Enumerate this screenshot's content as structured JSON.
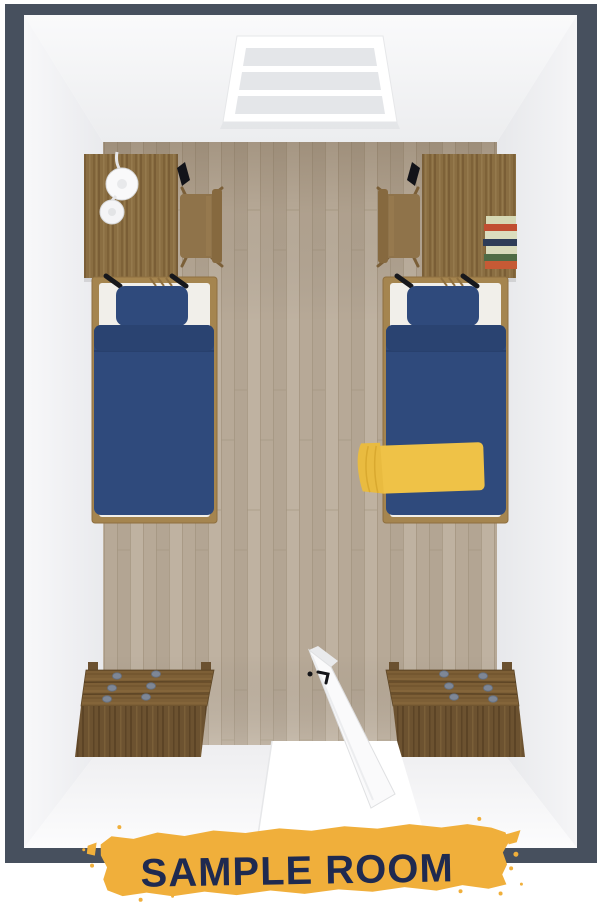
{
  "banner": {
    "label": "SAMPLE ROOM"
  },
  "room": {
    "description": "top-down 3D render of a sample dorm room",
    "objects": [
      "window",
      "desk-left",
      "desk-lamp",
      "desk-item-left",
      "chair-left",
      "desk-right",
      "chair-right",
      "book-stack",
      "desk-item-right",
      "bed-left",
      "pillow-left",
      "duvet-left",
      "bed-right",
      "pillow-right",
      "duvet-right",
      "yellow-blanket",
      "dresser-left",
      "dresser-right",
      "open-door",
      "doorway"
    ]
  },
  "colors": {
    "wall_top": "#47505E",
    "interior_wall": "#F1F2F4",
    "floor_base": "#B8AB99",
    "desk_wood": "#8A6E42",
    "chair_wood": "#8F734A",
    "bed_frame": "#A5854F",
    "mattress": "#F1EFEA",
    "bedding_blue": "#2F4A7C",
    "bedding_blue_dark": "#2A4371",
    "blanket_yellow": "#EFC247",
    "blanket_yellow_dark": "#E9BB40",
    "dresser_top": "#7D5F36",
    "dresser_front": "#6C5230",
    "knob_gray": "#7E8796",
    "door_white": "#FAFAFB",
    "window_pane": "#E4E6E9",
    "banner_yellow": "#F0AF3B",
    "banner_text": "#1F2A50"
  }
}
